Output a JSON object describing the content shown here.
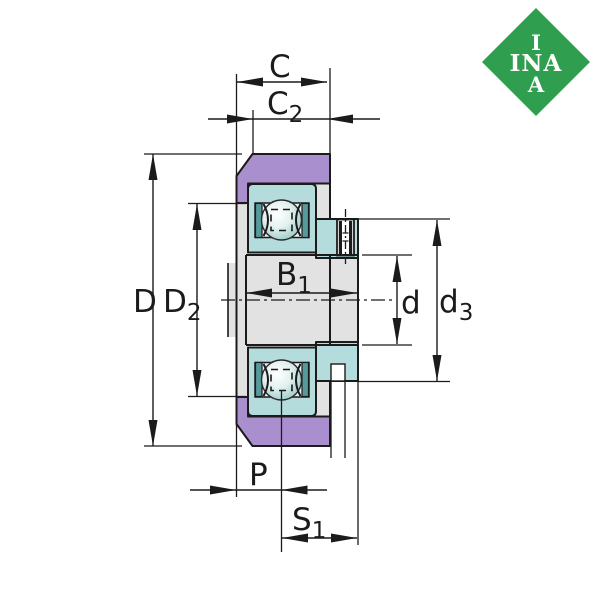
{
  "title": "Bearing cross-section technical drawing",
  "logo": {
    "row1": "I",
    "row2": "INA",
    "row3": "A"
  },
  "labels": {
    "C": {
      "main": "C",
      "sub": ""
    },
    "C2": {
      "main": "C",
      "sub": "2"
    },
    "D": {
      "main": "D",
      "sub": ""
    },
    "D2": {
      "main": "D",
      "sub": "2"
    },
    "B1": {
      "main": "B",
      "sub": "1"
    },
    "d": {
      "main": "d",
      "sub": ""
    },
    "d3": {
      "main": "d",
      "sub": "3"
    },
    "P": {
      "main": "P",
      "sub": ""
    },
    "S1": {
      "main": "S",
      "sub": "1"
    }
  },
  "colors": {
    "line": "#1b1b1b",
    "purple": "#a98fce",
    "teal": "#b5dcdc",
    "tealDark": "#579a9c",
    "gray": "#e2e2e2",
    "grayLight": "#f1f1f1",
    "white": "#ffffff",
    "ballEdge": "#9ccaca",
    "green": "#2f9e4f"
  }
}
